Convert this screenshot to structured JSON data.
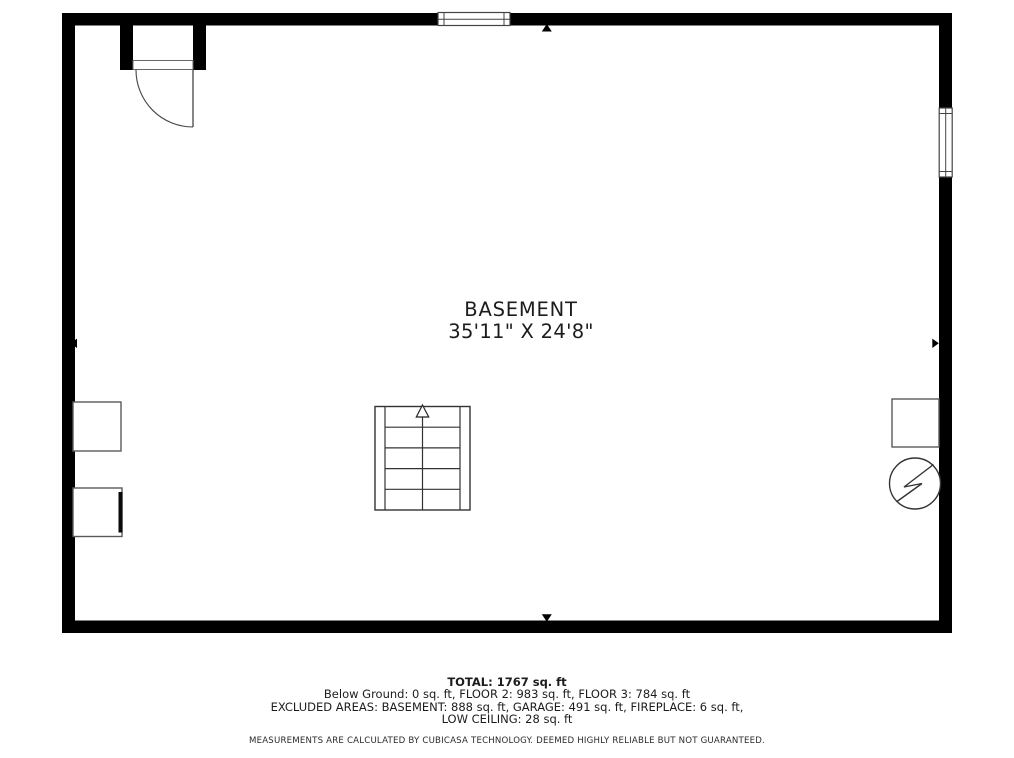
{
  "plan": {
    "room_label": "BASEMENT",
    "room_dimensions": "35'11\" X 24'8\"",
    "icons": {
      "door": "door-swing-icon",
      "window_top": "window-icon",
      "window_right": "window-icon",
      "stairs": "stairs-icon",
      "stairs_arrow": "up-arrow-icon",
      "water_heater": "water-heater-lightning-icon",
      "dimension_markers": [
        "up-arrow-icon",
        "down-arrow-icon",
        "left-arrow-icon",
        "right-arrow-icon"
      ]
    },
    "colors": {
      "wall": "#000000",
      "thin_line": "#444444",
      "fixture_line": "#5a5a5a",
      "text": "#1c1c1c",
      "background": "#ffffff"
    }
  },
  "footer": {
    "total": "TOTAL: 1767 sq. ft",
    "breakdown": "Below Ground: 0 sq. ft, FLOOR 2: 983 sq. ft, FLOOR 3: 784 sq. ft",
    "excluded_line1": "EXCLUDED AREAS: BASEMENT: 888 sq. ft, GARAGE: 491 sq. ft, FIREPLACE: 6 sq. ft,",
    "excluded_line2": "LOW CEILING: 28 sq. ft",
    "disclaimer": "MEASUREMENTS ARE CALCULATED BY CUBICASA TECHNOLOGY. DEEMED HIGHLY RELIABLE BUT NOT GUARANTEED."
  }
}
